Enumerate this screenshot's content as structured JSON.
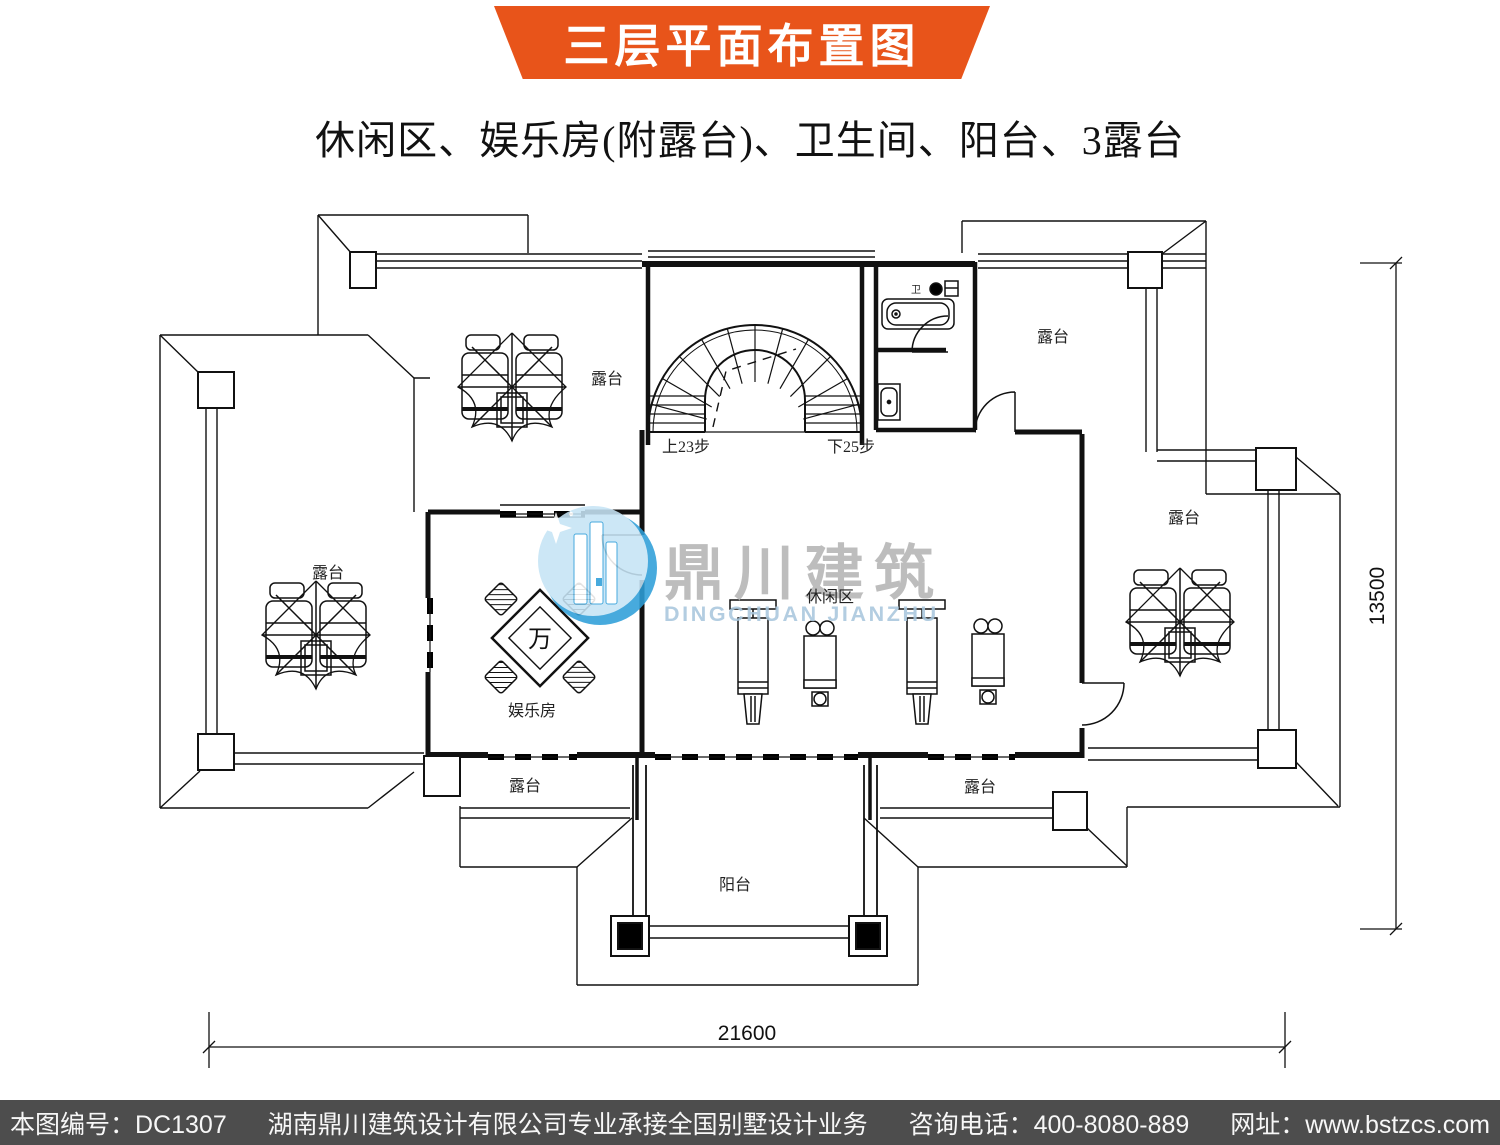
{
  "banner": {
    "title": "三层平面布置图",
    "bg_color": "#E8541A",
    "text_color": "#ffffff"
  },
  "subtitle": "休闲区、娱乐房(附露台)、卫生间、阳台、3露台",
  "watermark": {
    "cn": "鼎川建筑",
    "en": "DINGCHUAN JIANZHU",
    "circle_dark": "#2E9FD9",
    "circle_light": "#C6E4F5",
    "cn_color": "#b5b5b5",
    "en_color": "#a9c7dd"
  },
  "labels": {
    "terrace_top_left": "露台",
    "terrace_left": "露台",
    "terrace_top_right": "露台",
    "terrace_right": "露台",
    "terrace_bottom_left": "露台",
    "terrace_bottom_right": "露台",
    "entertainment_room": "娱乐房",
    "leisure_area": "休闲区",
    "balcony": "阳台",
    "bathroom_abbr": "卫",
    "stairs_up": "上23步",
    "stairs_down": "下25步",
    "mahjong_tile": "万"
  },
  "dimensions": {
    "width_mm": "21600",
    "height_mm": "13500"
  },
  "footer": {
    "bg_color": "#4D4D4D",
    "drawing_no": "本图编号：DC1307",
    "company": "湖南鼎川建筑设计有限公司专业承接全国别墅设计业务",
    "phone": "咨询电话：400-8080-889",
    "website": "网址：www.bstzcs.com"
  }
}
